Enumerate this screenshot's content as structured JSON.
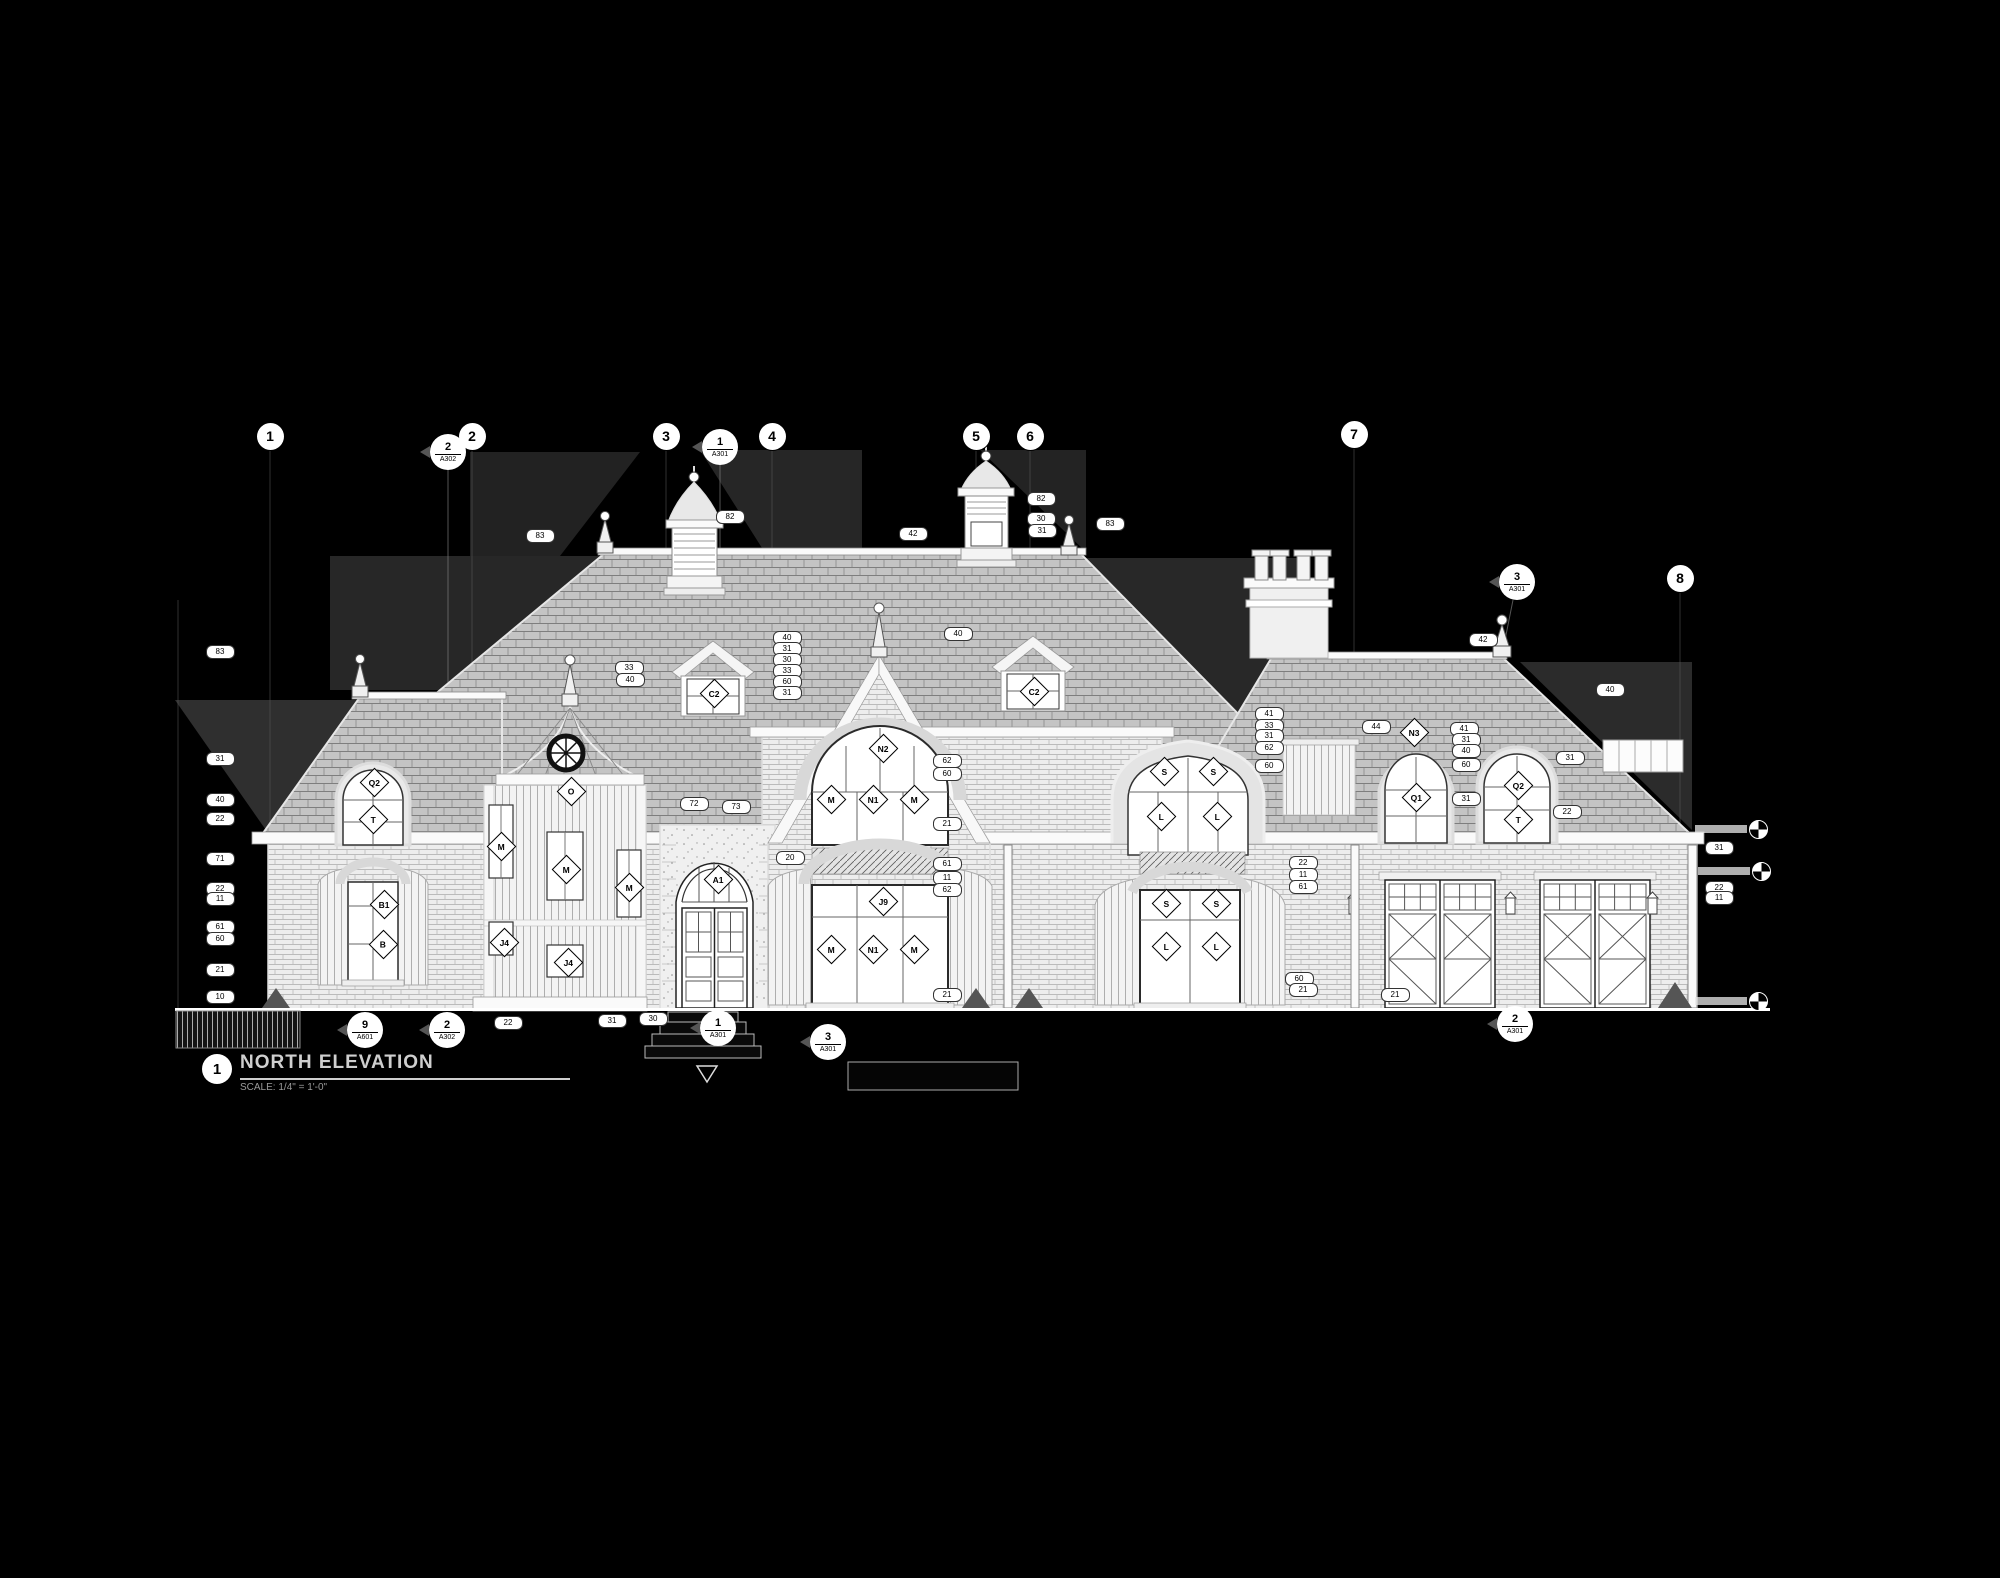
{
  "meta": {
    "view_number": "1",
    "view_title": "NORTH ELEVATION",
    "view_scale": "SCALE: 1/4\" = 1'-0\""
  },
  "colors": {
    "background": "#000000",
    "linework": "#e6e6e6",
    "roof_fill": "#c4c4c4",
    "wall_fill": "#eeeeee",
    "shadow_gray": "#2f2f2f",
    "annotation_bg": "#ffffff",
    "annotation_text": "#000000"
  },
  "grid_bubbles": [
    {
      "label": "1",
      "x": 270,
      "y": 436
    },
    {
      "label": "2",
      "x": 472,
      "y": 436
    },
    {
      "label": "3",
      "x": 666,
      "y": 436
    },
    {
      "label": "4",
      "x": 772,
      "y": 436
    },
    {
      "label": "5",
      "x": 976,
      "y": 436
    },
    {
      "label": "6",
      "x": 1030,
      "y": 436
    },
    {
      "label": "7",
      "x": 1354,
      "y": 434
    },
    {
      "label": "8",
      "x": 1680,
      "y": 578
    }
  ],
  "section_callouts": [
    {
      "num": "2",
      "sheet": "A302",
      "x": 448,
      "y": 452
    },
    {
      "num": "1",
      "sheet": "A301",
      "x": 720,
      "y": 447
    },
    {
      "num": "3",
      "sheet": "A301",
      "x": 1517,
      "y": 582
    },
    {
      "num": "9",
      "sheet": "A601",
      "x": 365,
      "y": 1030
    },
    {
      "num": "2",
      "sheet": "A302",
      "x": 447,
      "y": 1030
    },
    {
      "num": "1",
      "sheet": "A301",
      "x": 718,
      "y": 1028
    },
    {
      "num": "3",
      "sheet": "A301",
      "x": 828,
      "y": 1042
    },
    {
      "num": "2",
      "sheet": "A301",
      "x": 1515,
      "y": 1024
    }
  ],
  "window_tags": [
    {
      "label": "Q2",
      "x": 373,
      "y": 781
    },
    {
      "label": "T",
      "x": 372,
      "y": 818
    },
    {
      "label": "B1",
      "x": 383,
      "y": 903
    },
    {
      "label": "B",
      "x": 382,
      "y": 943
    },
    {
      "label": "O",
      "x": 570,
      "y": 790
    },
    {
      "label": "M",
      "x": 500,
      "y": 845
    },
    {
      "label": "M",
      "x": 565,
      "y": 868
    },
    {
      "label": "M",
      "x": 628,
      "y": 886
    },
    {
      "label": "J4",
      "x": 503,
      "y": 941
    },
    {
      "label": "J4",
      "x": 567,
      "y": 961
    },
    {
      "label": "A1",
      "x": 717,
      "y": 878
    },
    {
      "label": "C2",
      "x": 713,
      "y": 692
    },
    {
      "label": "C2",
      "x": 1033,
      "y": 690
    },
    {
      "label": "N2",
      "x": 882,
      "y": 747
    },
    {
      "label": "M",
      "x": 830,
      "y": 798
    },
    {
      "label": "N1",
      "x": 872,
      "y": 798
    },
    {
      "label": "M",
      "x": 913,
      "y": 798
    },
    {
      "label": "J9",
      "x": 882,
      "y": 900
    },
    {
      "label": "M",
      "x": 830,
      "y": 948
    },
    {
      "label": "N1",
      "x": 872,
      "y": 948
    },
    {
      "label": "M",
      "x": 913,
      "y": 948
    },
    {
      "label": "S",
      "x": 1163,
      "y": 770
    },
    {
      "label": "S",
      "x": 1212,
      "y": 770
    },
    {
      "label": "L",
      "x": 1160,
      "y": 815
    },
    {
      "label": "L",
      "x": 1216,
      "y": 815
    },
    {
      "label": "S",
      "x": 1165,
      "y": 902
    },
    {
      "label": "S",
      "x": 1215,
      "y": 902
    },
    {
      "label": "L",
      "x": 1165,
      "y": 945
    },
    {
      "label": "L",
      "x": 1215,
      "y": 945
    },
    {
      "label": "N3",
      "x": 1413,
      "y": 731
    },
    {
      "label": "Q1",
      "x": 1415,
      "y": 796
    },
    {
      "label": "Q2",
      "x": 1517,
      "y": 784
    },
    {
      "label": "T",
      "x": 1517,
      "y": 818
    }
  ],
  "keynote_ovals": [
    {
      "label": "83",
      "x": 219,
      "y": 651
    },
    {
      "label": "31",
      "x": 219,
      "y": 758
    },
    {
      "label": "40",
      "x": 219,
      "y": 799
    },
    {
      "label": "22",
      "x": 219,
      "y": 818
    },
    {
      "label": "71",
      "x": 219,
      "y": 858
    },
    {
      "label": "22",
      "x": 219,
      "y": 888
    },
    {
      "label": "11",
      "x": 219,
      "y": 898
    },
    {
      "label": "61",
      "x": 219,
      "y": 926
    },
    {
      "label": "60",
      "x": 219,
      "y": 938
    },
    {
      "label": "21",
      "x": 219,
      "y": 969
    },
    {
      "label": "10",
      "x": 219,
      "y": 996
    },
    {
      "label": "83",
      "x": 539,
      "y": 535
    },
    {
      "label": "82",
      "x": 729,
      "y": 516
    },
    {
      "label": "42",
      "x": 912,
      "y": 533
    },
    {
      "label": "82",
      "x": 1040,
      "y": 498
    },
    {
      "label": "30",
      "x": 1040,
      "y": 518
    },
    {
      "label": "31",
      "x": 1041,
      "y": 530
    },
    {
      "label": "83",
      "x": 1109,
      "y": 523
    },
    {
      "label": "40",
      "x": 957,
      "y": 633
    },
    {
      "label": "33",
      "x": 628,
      "y": 667
    },
    {
      "label": "40",
      "x": 629,
      "y": 679
    },
    {
      "label": "40",
      "x": 786,
      "y": 637
    },
    {
      "label": "31",
      "x": 786,
      "y": 648
    },
    {
      "label": "30",
      "x": 786,
      "y": 659
    },
    {
      "label": "33",
      "x": 786,
      "y": 670
    },
    {
      "label": "60",
      "x": 786,
      "y": 681
    },
    {
      "label": "31",
      "x": 786,
      "y": 692
    },
    {
      "label": "42",
      "x": 1482,
      "y": 639
    },
    {
      "label": "40",
      "x": 1609,
      "y": 689
    },
    {
      "label": "41",
      "x": 1268,
      "y": 713
    },
    {
      "label": "33",
      "x": 1268,
      "y": 725
    },
    {
      "label": "31",
      "x": 1268,
      "y": 735
    },
    {
      "label": "62",
      "x": 1268,
      "y": 747
    },
    {
      "label": "60",
      "x": 1268,
      "y": 765
    },
    {
      "label": "44",
      "x": 1375,
      "y": 726
    },
    {
      "label": "41",
      "x": 1463,
      "y": 728
    },
    {
      "label": "31",
      "x": 1465,
      "y": 739
    },
    {
      "label": "40",
      "x": 1465,
      "y": 750
    },
    {
      "label": "60",
      "x": 1465,
      "y": 764
    },
    {
      "label": "31",
      "x": 1465,
      "y": 798
    },
    {
      "label": "31",
      "x": 1569,
      "y": 757
    },
    {
      "label": "22",
      "x": 1566,
      "y": 811
    },
    {
      "label": "72",
      "x": 693,
      "y": 803
    },
    {
      "label": "73",
      "x": 735,
      "y": 806
    },
    {
      "label": "20",
      "x": 789,
      "y": 857
    },
    {
      "label": "62",
      "x": 946,
      "y": 760
    },
    {
      "label": "60",
      "x": 946,
      "y": 773
    },
    {
      "label": "21",
      "x": 946,
      "y": 823
    },
    {
      "label": "61",
      "x": 946,
      "y": 863
    },
    {
      "label": "11",
      "x": 946,
      "y": 877
    },
    {
      "label": "62",
      "x": 946,
      "y": 889
    },
    {
      "label": "60",
      "x": 1298,
      "y": 978
    },
    {
      "label": "21",
      "x": 1302,
      "y": 989
    },
    {
      "label": "21",
      "x": 1394,
      "y": 994
    },
    {
      "label": "22",
      "x": 1302,
      "y": 862
    },
    {
      "label": "11",
      "x": 1302,
      "y": 874
    },
    {
      "label": "61",
      "x": 1302,
      "y": 886
    },
    {
      "label": "31",
      "x": 1718,
      "y": 847
    },
    {
      "label": "22",
      "x": 1718,
      "y": 887
    },
    {
      "label": "11",
      "x": 1718,
      "y": 897
    },
    {
      "label": "22",
      "x": 507,
      "y": 1022
    },
    {
      "label": "31",
      "x": 611,
      "y": 1020
    },
    {
      "label": "30",
      "x": 652,
      "y": 1018
    },
    {
      "label": "21",
      "x": 946,
      "y": 994
    }
  ],
  "datum_markers": [
    {
      "x": 1757,
      "y": 828
    },
    {
      "x": 1760,
      "y": 870
    },
    {
      "x": 1757,
      "y": 1000
    }
  ]
}
